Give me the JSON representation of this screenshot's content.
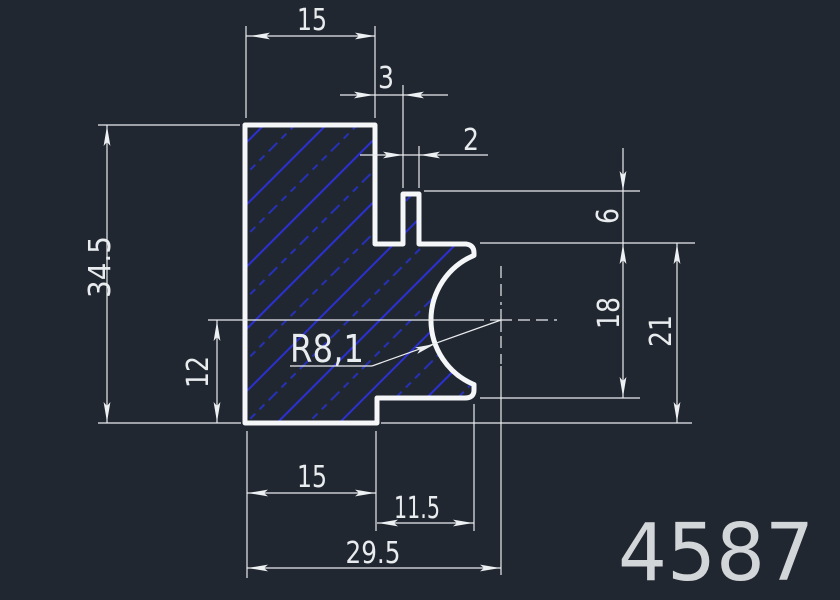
{
  "drawing": {
    "part_number": "4587",
    "labels": {
      "top_width": "15",
      "groove_offset": "3",
      "slot_width": "2",
      "tab_height": "6",
      "step_depth": "18",
      "right_height": "21",
      "overall_height": "34.5",
      "center_height": "12",
      "bottom_width": "15",
      "step_width": "11.5",
      "overall_width": "29.5",
      "radius": "R8,1"
    },
    "colors": {
      "background": "#212730",
      "outline": "#f4f6f8",
      "hatch": "#2b30d2",
      "dimension_lines": "#e9ecef",
      "part_number_text": "#d3d6d9"
    }
  }
}
